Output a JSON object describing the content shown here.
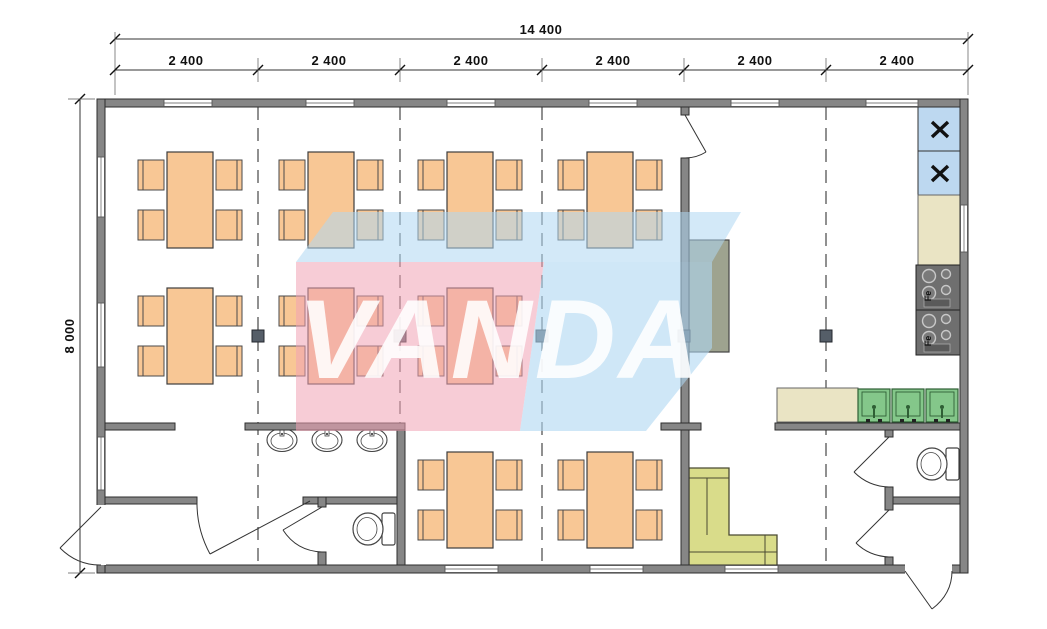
{
  "watermark": {
    "text": "VANDA",
    "pink_color": "#F0A3B4",
    "blue_color": "#AFD7F2",
    "text_color": "#FFFFFF"
  },
  "dimensions": {
    "top_total_label": "14 400",
    "top_modules": [
      "2 400",
      "2 400",
      "2 400",
      "2 400",
      "2 400",
      "2 400"
    ],
    "left_total_label": "8 000"
  },
  "plan": {
    "stove_marking": "Fe",
    "colors": {
      "wall_gray": "#868686",
      "table_orange": "#F8C795",
      "sofa_green": "#D9DC8A",
      "sink_green": "#84C78A",
      "fridge_blue": "#BDD8F0",
      "counter_beige": "#EAE4C4",
      "stove_gray": "#6F6F6F",
      "cabinet_olive": "#9EA38F",
      "flame_orange": "#D2691E",
      "marker_gray": "#555E68"
    },
    "inventory": {
      "dining_table_sets": 9,
      "chairs_per_table": 4,
      "wash_basins": 3,
      "kitchen_sinks": 3,
      "toilets": 2,
      "stoves": 2,
      "refrigerators": 2,
      "sofas": 1,
      "cabinets": 1
    }
  }
}
